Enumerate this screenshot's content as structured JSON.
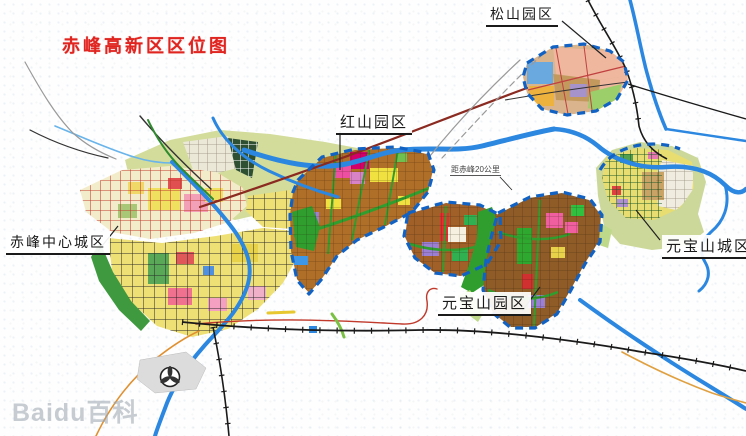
{
  "title": "赤峰高新区区位图",
  "watermark": "Baidu百科",
  "annotations": {
    "distance_note": "距赤峰20公里"
  },
  "regions": {
    "songshan_park": {
      "label": "松山园区"
    },
    "hongshan_park": {
      "label": "红山园区"
    },
    "chifeng_central_city": {
      "label": "赤峰中心城区"
    },
    "yuanbaoshan_park": {
      "label": "元宝山园区"
    },
    "yuanbaoshan_city": {
      "label": "元宝山城区"
    }
  },
  "palette": {
    "title_red": "#e02420",
    "river_blue": "#2b87e0",
    "park_boundary_blue": "#1262c4",
    "industrial_brown": "#a9661f",
    "residential_yellow": "#efe075",
    "green_space": "#2f9e2f",
    "olive_farmland": "#d3dc9b",
    "old_town_red_grid": "#c23b2e",
    "railway_black": "#1a1a1a",
    "highway_maroon": "#8a2a20",
    "songshan_salmon": "#efb79e"
  }
}
